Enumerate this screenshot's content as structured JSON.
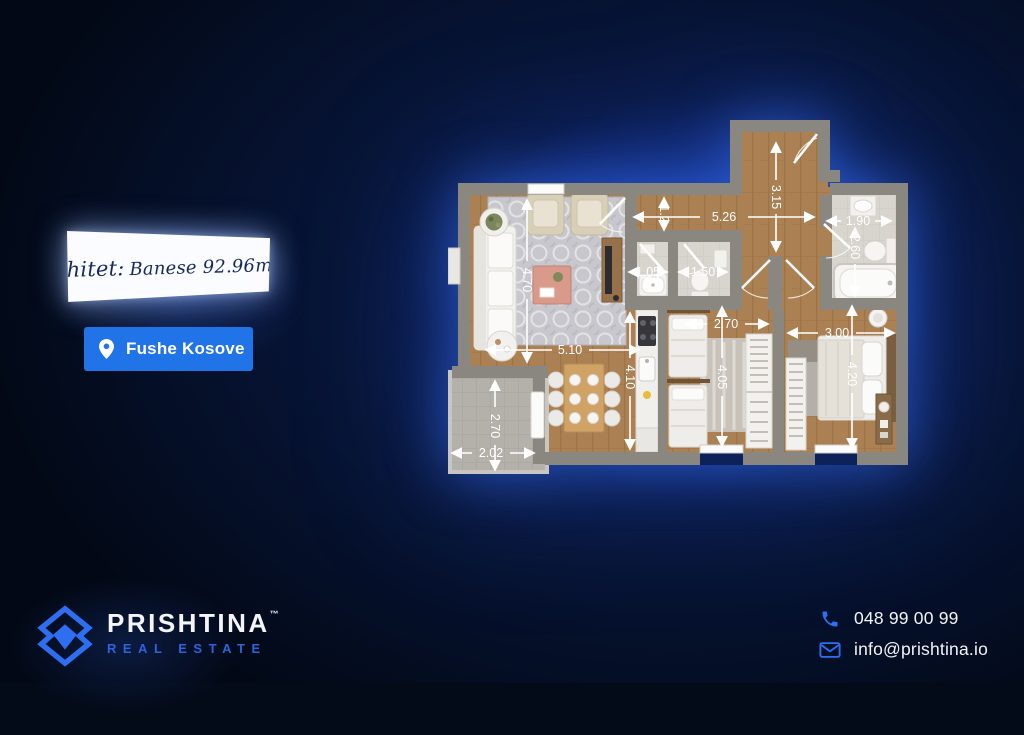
{
  "banner": {
    "prefix": "Shitet:",
    "title": "Banese 92.96m2"
  },
  "location": {
    "label": "Fushe Kosove"
  },
  "brand": {
    "name": "PRISHTINA",
    "trademark": "™",
    "tagline": "REAL ESTATE"
  },
  "contact": {
    "phone": "048 99 00 99",
    "email": "info@prishtina.io"
  },
  "colors": {
    "accent_blue": "#2173e8",
    "logo_blue": "#2e62d9",
    "glow_blue": "#1c3ea6",
    "background": "#030a18",
    "wood_floor": "#ab8153",
    "wall_gray": "#8a8680",
    "bath_tile": "#d8d4ce",
    "balcony_tile": "#b4b1ab"
  },
  "floorplan": {
    "dims": [
      {
        "id": "hall-width",
        "label": "5.26"
      },
      {
        "id": "entry-depth",
        "label": "3.15"
      },
      {
        "id": "corridor-width",
        "label": "1.2"
      },
      {
        "id": "wc1-width",
        "label": "1.05"
      },
      {
        "id": "wc2-width",
        "label": "1.50"
      },
      {
        "id": "bath-width",
        "label": "1.90"
      },
      {
        "id": "bath-depth",
        "label": "2.60"
      },
      {
        "id": "bedroom1-width",
        "label": "2.70"
      },
      {
        "id": "bedroom2-width",
        "label": "3.00"
      },
      {
        "id": "living-width",
        "label": "5.10"
      },
      {
        "id": "kitchen-depth",
        "label": "4.10"
      },
      {
        "id": "living-depth",
        "label": "4.70"
      },
      {
        "id": "bedroom1-depth",
        "label": "4.05"
      },
      {
        "id": "bedroom2-depth",
        "label": "4.20"
      },
      {
        "id": "balcony-depth",
        "label": "2.70"
      },
      {
        "id": "balcony-width",
        "label": "2.02"
      }
    ]
  }
}
